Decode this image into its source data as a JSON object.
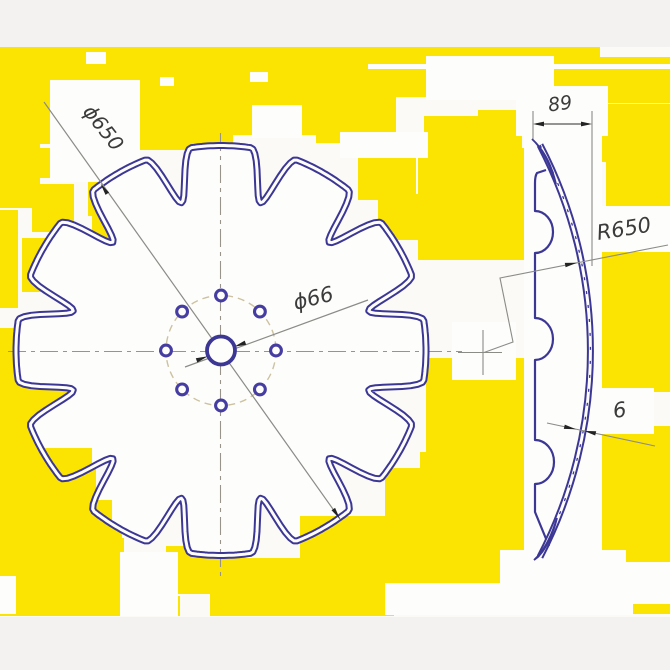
{
  "title": "Notched disc blade technical drawing",
  "dimensions": {
    "front_diameter": "ϕ650",
    "hub_diameter": "ϕ66",
    "profile_width": "89",
    "dish_radius": "R650",
    "thickness": "6"
  },
  "drawing": {
    "teeth": 12,
    "bolt_holes": 8,
    "center": [
      221,
      350.5
    ],
    "outer_radius": 205,
    "valley_radius": 153,
    "flat_half_deg": 8.4,
    "bolt_circle_radius": 55,
    "hub_radius": 14,
    "hole_radius": 5.4
  },
  "colors": {
    "outline_blue": "#3c3795",
    "hole_blue": "#463da2",
    "noise_yellow": "#fbe402",
    "dim_gray": "#8b8b88",
    "arrow_black": "#232323",
    "centerline": "#98948b",
    "bolt_circle_tan": "#ccc2a0",
    "paper": "#fbfaf7",
    "margin": "#f3f2f0"
  }
}
